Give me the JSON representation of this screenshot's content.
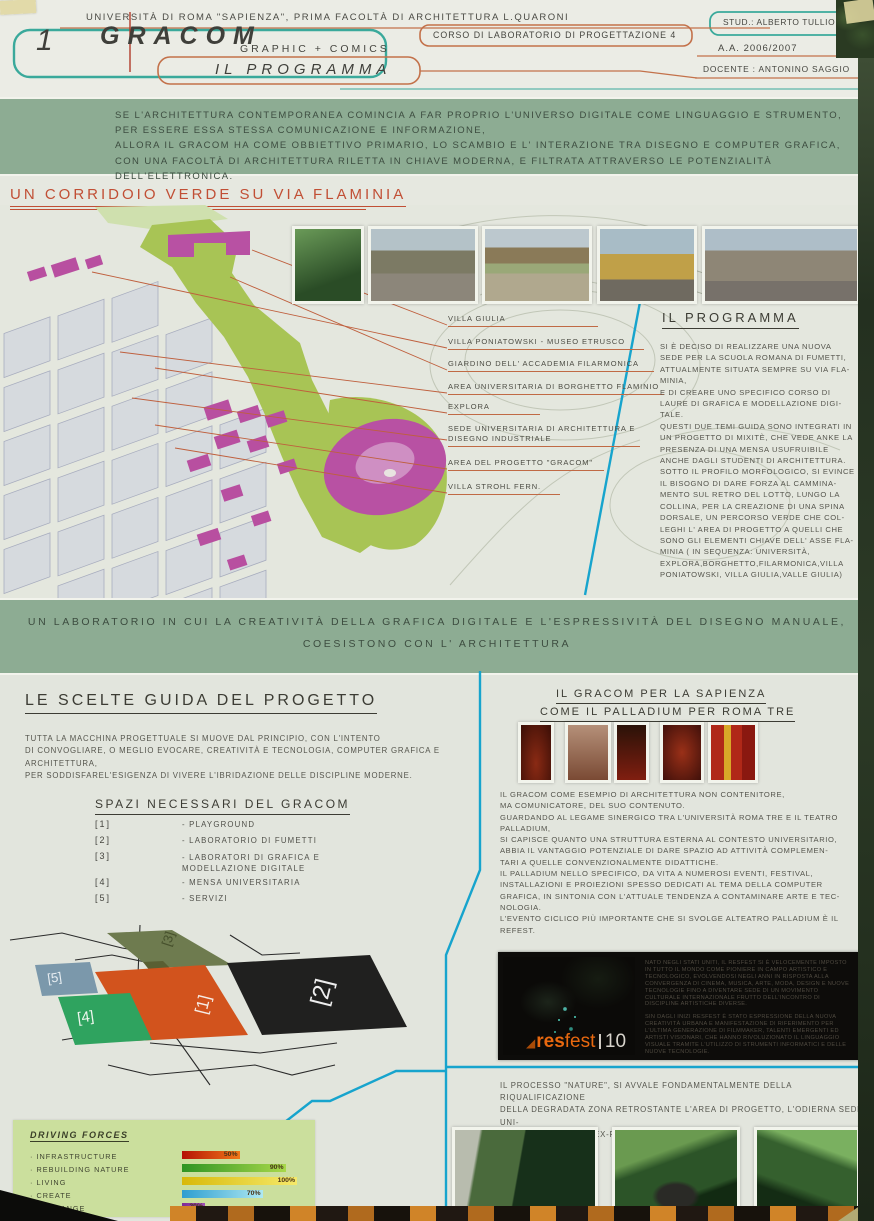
{
  "header": {
    "panel_number": "1",
    "university": "UNIVERSITÀ DI ROMA \"SAPIENZA\",  PRIMA FACOLTÀ DI ARCHITETTURA L.QUARONI",
    "logo": "GRACOM",
    "logo_sub": "GRAPHIC + COMICS",
    "page_title": "IL PROGRAMMA",
    "course": "CORSO DI LABORATORIO DI PROGETTAZIONE 4",
    "student": "STUD.: ALBERTO TULLIO",
    "year": "A.A. 2006/2007",
    "teacher": "DOCENTE : ANTONINO SAGGIO"
  },
  "intro_banner": {
    "text": "SE L'ARCHITETTURA CONTEMPORANEA COMINCIA A FAR PROPRIO L'UNIVERSO DIGITALE COME LINGUAGGIO E STRUMENTO,\nPER ESSERE ESSA STESSA COMUNICAZIONE E INFORMAZIONE,\nALLORA IL GRACOM HA COME OBBIETTIVO PRIMARIO, LO SCAMBIO E L' INTERAZIONE TRA DISEGNO E COMPUTER GRAFICA,\nCON UNA FACOLTÀ DI ARCHITETTURA RILETTA IN CHIAVE MODERNA, E FILTRATA ATTRAVERSO LE POTENZIALITÀ DELL'ELETTRONICA."
  },
  "corridor": {
    "heading": "UN CORRIDOIO VERDE SU VIA FLAMINIA",
    "labels": [
      "VILLA GIULIA",
      "VILLA PONIATOWSKI - MUSEO ETRUSCO",
      "GIARDINO DELL' ACCADEMIA FILARMONICA",
      "AREA UNIVERSITARIA DI BORGHETTO FLAMINIO",
      "EXPLORA",
      "SEDE UNIVERSITARIA DI ARCHITETTURA E\nDISEGNO INDUSTRIALE",
      "AREA DEL PROGETTO \"GRACOM\"",
      "VILLA STROHL FERN."
    ],
    "program_heading": "IL PROGRAMMA",
    "program_body": "SI È DECISO DI REALIZZARE UNA NUOVA\nSEDE PER LA SCUOLA ROMANA DI FUMETTI,\nATTUALMENTE SITUATA SEMPRE SU VIA FLA-\nMINIA,\nE DI CREARE UNO SPECIFICO CORSO DI\nLAURE DI GRAFICA E MODELLAZIONE DIGI-\nTALE.\nQUESTI DUE TEMI GUIDA SONO INTEGRATI IN\nUN PROGETTO DI MIXITÈ, CHE VEDE ANKE LA\nPRESENZA DI UNA MENSA USUFRUIBILE\nANCHE DAGLI STUDENTI DI ARCHITETTURA.\nSOTTO IL PROFILO MORFOLOGICO, SI EVINCE\nIL BISOGNO DI DARE FORZA AL CAMMINA-\nMENTO SUL RETRO DEL LOTTO, LUNGO LA\nCOLLINA, PER LA CREAZIONE DI UNA SPINA\nDORSALE, UN PERCORSO VERDE CHE COL-\nLEGHI L' AREA DI PROGETTO A QUELLI CHE\nSONO GLI ELEMENTI CHIAVE DELL' ASSE FLA-\nMINIA ( IN SEQUENZA: UNIVERSITÀ,\nEXPLORA,BORGHETTO,FILARMONICA,VILLA\nPONIATOWSKI, VILLA GIULIA,VALLE GIULIA)"
  },
  "lab_banner": {
    "line1": "UN LABORATORIO IN CUI LA CREATIVITÀ DELLA GRAFICA DIGITALE E L'ESPRESSIVITÀ DEL DISEGNO MANUALE,",
    "line2": "COESISTONO CON L' ARCHITETTURA"
  },
  "choices": {
    "heading": "LE SCELTE GUIDA DEL PROGETTO",
    "body": "TUTTA LA MACCHINA PROGETTUALE SI MUOVE DAL PRINCIPIO, CON L'INTENTO\nDI CONVOGLIARE, O MEGLIO EVOCARE, CREATIVITÀ E TECNOLOGIA, COMPUTER GRAFICA E\nARCHITETTURA,\nPER SODDISFAREL'ESIGENZA DI VIVERE L'IBRIDAZIONE DELLE DISCIPLINE MODERNE.",
    "spaces_heading": "SPAZI NECESSARI DEL GRACOM",
    "spaces": [
      {
        "num": "[1]",
        "label": "- PLAYGROUND"
      },
      {
        "num": "[2]",
        "label": "- LABORATORIO DI FUMETTI"
      },
      {
        "num": "[3]",
        "label": "- LABORATORI DI GRAFICA E\n  MODELLAZIONE DIGITALE"
      },
      {
        "num": "[4]",
        "label": "- MENSA UNIVERSITARIA"
      },
      {
        "num": "[5]",
        "label": "- SERVIZI"
      }
    ],
    "diagram_labels": {
      "b1": "[1]",
      "b2": "[2]",
      "b3": "[3]",
      "b4": "[4]",
      "b5": "[5]"
    }
  },
  "sapienza": {
    "heading_line1": "IL GRACOM PER LA SAPIENZA",
    "heading_line2": "COME IL PALLADIUM PER ROMA TRE",
    "body": "IL GRACOM COME ESEMPIO DI ARCHITETTURA NON CONTENITORE,\nMA COMUNICATORE, DEL  SUO CONTENUTO.\nGUARDANDO AL LEGAME SINERGICO TRA L'UNIVERSITÀ ROMA TRE E IL TEATRO\nPALLADIUM,\nSI CAPISCE QUANTO UNA STRUTTURA ESTERNA AL CONTESTO UNIVERSITARIO,\nABBIA IL VANTAGGIO POTENZIALE DI DARE SPAZIO AD ATTIVITÀ COMPLEMEN-\nTARI A QUELLE CONVENZIONALMENTE DIDATTICHE.\nIL PALLADIUM NELLO SPECIFICO, DA VITA A NUMEROSI EVENTI, FESTIVAL,\nINSTALLAZIONI E PROIEZIONI SPESSO DEDICATI AL TEMA DELLA COMPUTER\nGRAFICA, IN SINTONIA CON L'ATTUALE TENDENZA A CONTAMINARE ARTE E TEC-\nNOLOGIA.\nL'EVENTO CICLICO PIÙ IMPORTANTE CHE SI SVOLGE ALTEATRO PALLADIUM È IL\nREFEST."
  },
  "resfest": {
    "logo_text_bold": "res",
    "logo_text_light": "fest",
    "logo_number": "10",
    "col1": "NATO NEGLI STATI UNITI, IL RESFEST SI È VELOCEMENTE IMPOSTO IN TUTTO IL MONDO COME PIONIERE IN CAMPO ARTISTICO E TECNOLOGICO, EVOLVENDOSI NEGLI ANNI IN RISPOSTA ALLA CONVERGENZA DI CINEMA, MUSICA, ARTE, MODA, DESIGN E NUOVE TECNOLOGIE FINO A DIVENTARE SEDE DI UN MOVIMENTO CULTURALE INTERNAZIONALE FRUTTO DELL'INCONTRO DI DISCIPLINE ARTISTICHE DIVERSE.",
    "col2": "SIN DAGLI INIZI RESFEST È STATO ESPRESSIONE DELLA NUOVA CREATIVITÀ URBANA E MANIFESTAZIONE DI RIFERIMENTO PER L'ULTIMA GENERAZIONE DI FILMMAKER, TALENTI EMERGENTI ED ARTISTI VISIONARI, CHE HANNO RIVOLUZIONATO IL LINGUAGGIO VISUALE TRAMITE L'UTILIZZO DI STRUMENTI INFORMATICI E DELLE NUOVE TECNOLOGIE."
  },
  "nature": {
    "body": "IL PROCESSO \"NATURE\", SI AVVALE FONDAMENTALMENTE DELLA RIQUALIFICAZIONE\nDELLA DEGRADATA ZONA RETROSTANTE L'AREA DI PROGETTO, L'ODIERNA SEDE UNI-\nVERSITARIA, L'AREA EX-FIAT,"
  },
  "driving_forces": {
    "title": "DRIVING FORCES",
    "items": [
      {
        "label": "· INFRASTRUCTURE",
        "value": "50%",
        "pct": 50,
        "color_from": "#b51205",
        "color_to": "#f07818"
      },
      {
        "label": "· REBUILDING NATURE",
        "value": "90%",
        "pct": 90,
        "color_from": "#2f9423",
        "color_to": "#a8d84a"
      },
      {
        "label": "· LIVING",
        "value": "100%",
        "pct": 100,
        "color_from": "#d8b90a",
        "color_to": "#f5e96a"
      },
      {
        "label": "· CREATE",
        "value": "70%",
        "pct": 70,
        "color_from": "#2e9ed0",
        "color_to": "#aee8f2"
      },
      {
        "label": "· EXCHANGE",
        "value": "20%",
        "pct": 20,
        "color_from": "#7e2b96",
        "color_to": "#a050b5"
      }
    ]
  },
  "accent_colors": {
    "teal_outline": "#3aa99b",
    "orange_outline": "#c3714a",
    "cyan_line": "#17a4cd",
    "banner_green": "#8dac93",
    "heading_red": "#c14f35"
  }
}
